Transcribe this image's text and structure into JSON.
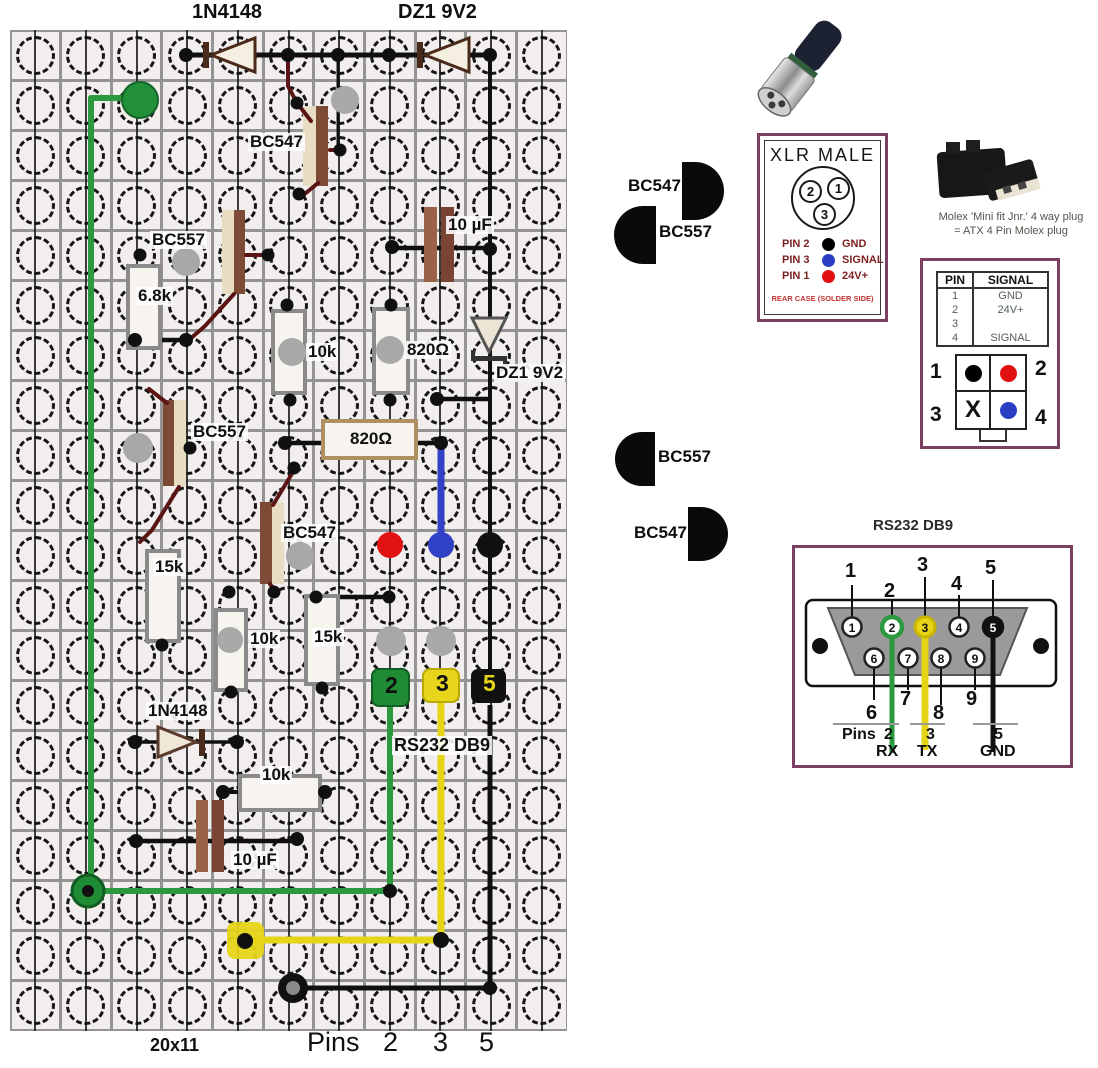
{
  "colors": {
    "green_wire": "#2b9a3f",
    "yellow_wire": "#e6d417",
    "blue_wire": "#3142c6",
    "red_dot": "#e01212",
    "dark_red_lead": "#5a1414",
    "panel_border": "#7b3f62",
    "gray_pad": "#a8a8a8"
  },
  "board": {
    "size_label": "20x11",
    "labels": [
      "1N4148",
      "DZ1 9V2",
      "BC547",
      "BC557",
      "6.8k",
      "10k",
      "820Ω",
      "10 µF",
      "DZ1 9V2",
      "BC557",
      "820Ω",
      "BC547",
      "15k",
      "10k",
      "15k",
      "1N4148",
      "RS232 DB9",
      "10k",
      "10 µF",
      "20x11"
    ],
    "pads": {
      "p2": "2",
      "p3": "3",
      "p5": "5"
    },
    "pins_caption": {
      "word": "Pins",
      "n2": "2",
      "n3": "3",
      "n5": "5"
    }
  },
  "transistor_symbols": {
    "s1": "BC547",
    "s2": "BC557",
    "s3": "BC557",
    "s4": "BC547"
  },
  "xlr": {
    "title": "XLR MALE",
    "circle_pins": {
      "c2": "2",
      "c1": "1",
      "c3": "3"
    },
    "legend": [
      {
        "pin": "PIN 2",
        "signal": "GND",
        "color": "#000000"
      },
      {
        "pin": "PIN 3",
        "signal": "SIGNAL",
        "color": "#2b3fc4"
      },
      {
        "pin": "PIN 1",
        "signal": "24V+",
        "color": "#e01010"
      }
    ],
    "footer": "REAR CASE (SOLDER SIDE)"
  },
  "molex": {
    "caption_line1": "Molex 'Mini fit Jnr.' 4 way plug",
    "caption_line2": "=  ATX 4 Pin Molex  plug",
    "table": {
      "headers": [
        "PIN",
        "SIGNAL"
      ],
      "rows": [
        [
          "1",
          "GND"
        ],
        [
          "2",
          "24V+"
        ],
        [
          "3",
          ""
        ],
        [
          "4",
          "SIGNAL"
        ]
      ]
    },
    "connector": {
      "n1": "1",
      "n2": "2",
      "n3": "3",
      "n4": "4",
      "x_mark": "X",
      "pin1_color": "#000000",
      "pin2_color": "#e01010",
      "pin4_color": "#2b3fc4"
    }
  },
  "rs232": {
    "title": "RS232 DB9",
    "pins_top": [
      "1",
      "2",
      "3",
      "4",
      "5"
    ],
    "pins_bottom": [
      "6",
      "7",
      "8",
      "9"
    ],
    "caption": {
      "pins": "Pins",
      "p2": "2",
      "r2": "RX",
      "p3": "3",
      "r3": "TX",
      "p5": "5",
      "r5": "GND"
    }
  }
}
